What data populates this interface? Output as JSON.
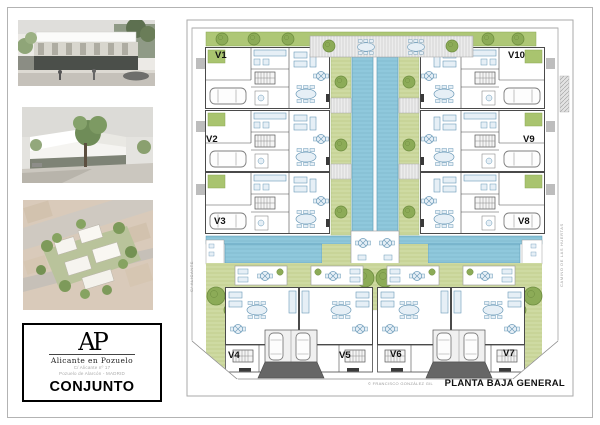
{
  "logo": {
    "monogram": "AP",
    "name": "Alicante en Pozuelo",
    "address_line1": "C/ Alicante nº 17",
    "address_line2": "Pozuelo de Alarcón - MADRID",
    "sheet_label": "CONJUNTO"
  },
  "plan": {
    "title": "PLANTA BAJA GENERAL",
    "credit": "© FRANCISCO GONZÁLEZ GIL",
    "street_left": "C/ ALICANTE",
    "street_right": "CAMINO DE LAS HUERTAS",
    "unit_labels": [
      "V1",
      "V2",
      "V3",
      "V4",
      "V5",
      "V6",
      "V7",
      "V8",
      "V9",
      "V10"
    ],
    "colors": {
      "lawn": "#cedaa2",
      "hedge": "#aec776",
      "tree": "#8cab57",
      "water": "#8fc8dc",
      "ramp": "#666666",
      "wall": "#4a4a4a",
      "furniture": "#6b9ab8"
    }
  }
}
